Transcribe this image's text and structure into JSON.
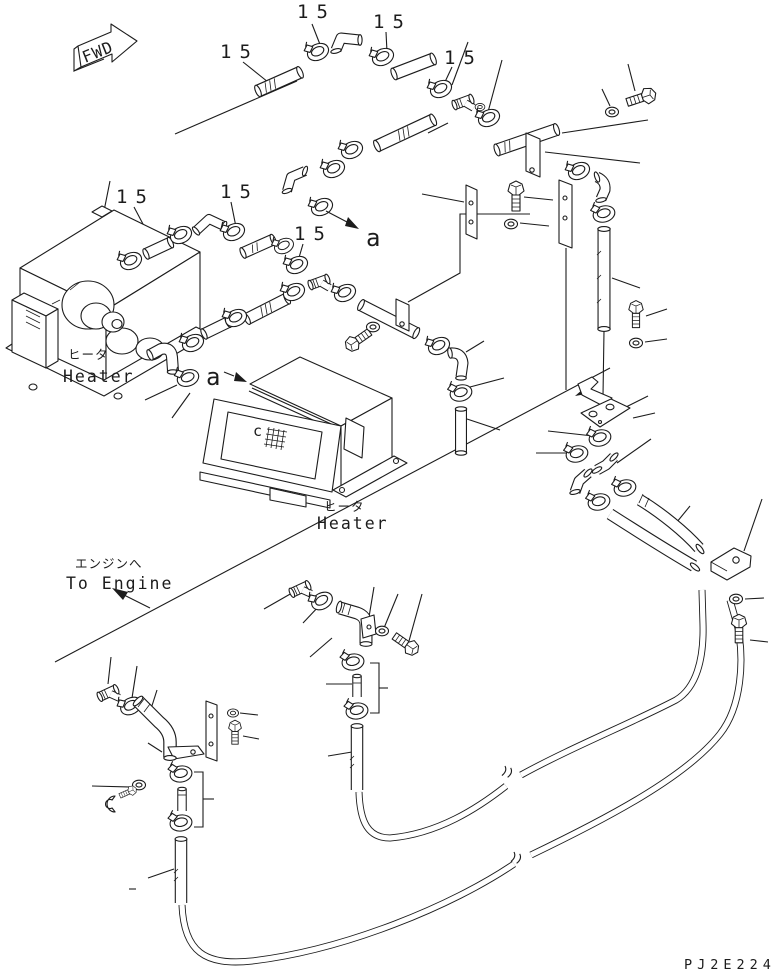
{
  "drawing": {
    "code": "PJ2E224",
    "orientation_label": "FWD",
    "part_number_label": "15",
    "view_marker_label": "a",
    "core_marker_label": "c",
    "captions": {
      "heater_jp": "ヒータ",
      "heater_en": "Heater",
      "to_engine_jp": "エンジンへ",
      "to_engine_en": "To Engine"
    },
    "colors": {
      "line": "#1c1c1c",
      "background": "#ffffff"
    }
  }
}
